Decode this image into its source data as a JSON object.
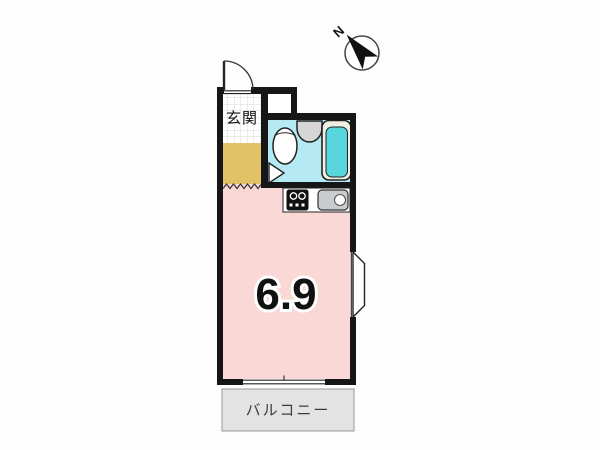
{
  "compass": {
    "label": "N"
  },
  "rooms": {
    "genkan": {
      "label": "玄関"
    },
    "main": {
      "size_label": "6.9"
    },
    "balcony": {
      "label": "バルコニー"
    }
  },
  "colors": {
    "wall": "#161616",
    "room_pink": "#f9d8d5",
    "genkan_yellow": "#e2c267",
    "bath_cyan": "#b5eaf4",
    "tub_teal": "#57d7dd",
    "tub_rim": "#f1efe2",
    "fixture_grey": "#d6d6d6",
    "sink_grey": "#c9cccf",
    "balcony_grey": "#e3e3e3",
    "tile_line_grey": "#d8d8d8",
    "label_dark": "#3c3c3c"
  }
}
